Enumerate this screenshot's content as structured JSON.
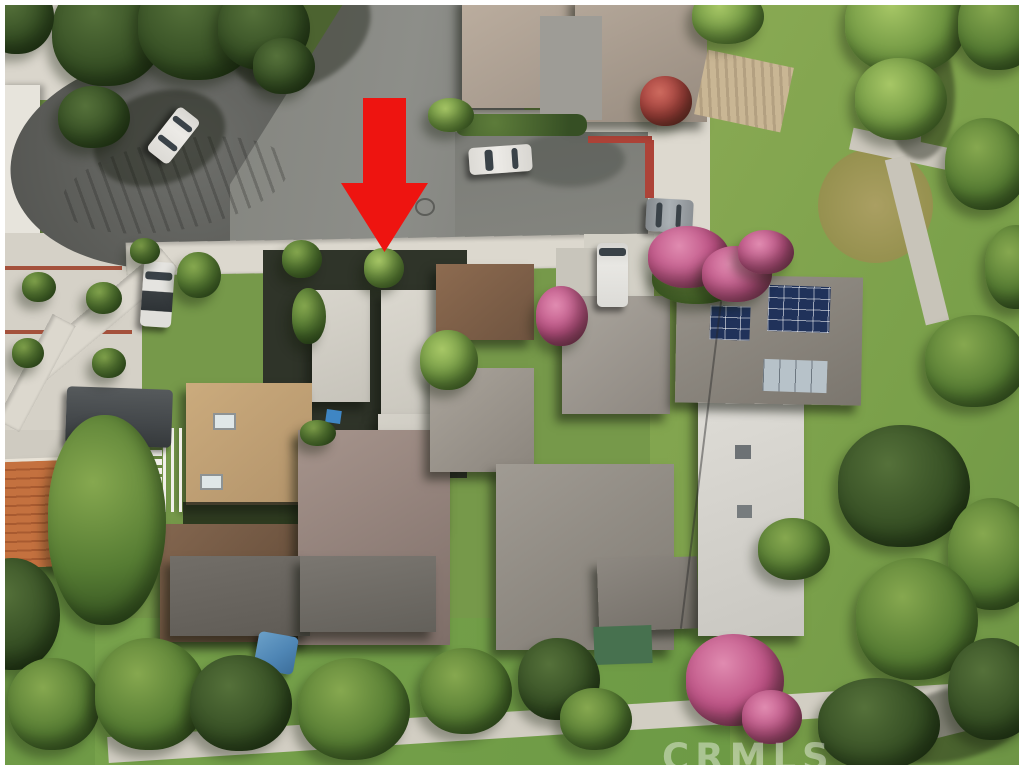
{
  "meta": {
    "kind": "aerial-drone-photograph",
    "subject": "residential cul-de-sac neighborhood, listing photo"
  },
  "watermark": {
    "text": "CRMLS"
  },
  "annotation_arrow": {
    "shape": "down-arrow",
    "color": "#ee1410",
    "points_at": "subject property at end of cul-de-sac street"
  },
  "palette": {
    "asphalt": "#6e6f6b",
    "asphalt_dark": "#595a56",
    "concrete": "#dcd8ce",
    "grass": "#7aa24c",
    "grass_dry": "#a89e63",
    "tree_dark": "#364f24",
    "tree_bright": "#6d9440",
    "roof_tan_flat": "#c2a377",
    "roof_brown_shingle": "#75593f",
    "roof_mauve_shingle": "#9c8a82",
    "roof_gray_shingle": "#a19c94",
    "roof_white_flat": "#dbd9d3",
    "roof_tile_orange": "#c4713f",
    "solar_panel_blue": "#20325a",
    "solar_panel_silver": "#b7c2c9",
    "red_curb": "#ad4338",
    "bougainvillea_pink": "#bb4f82",
    "umbrella_blue": "#4f86b5"
  },
  "objects": {
    "cars": [
      {
        "name": "white car in cul-de-sac",
        "color": "#eceae6"
      },
      {
        "name": "white sedan in parking court",
        "color": "#eceae6"
      },
      {
        "name": "silver car on right curb",
        "color": "#9aa0a4"
      },
      {
        "name": "white van in driveway",
        "color": "#e8e7e3"
      },
      {
        "name": "white car parked on left street",
        "color": "#e5e4e0"
      },
      {
        "name": "dark covered vehicle lower left",
        "color": "#4a4e50"
      }
    ],
    "features": [
      "cul-de-sac with tire marks",
      "red painted curb",
      "rooftop solar arrays",
      "blue patio umbrella",
      "orange spanish tile roof",
      "park walking paths",
      "pink bougainvillea trees"
    ]
  }
}
